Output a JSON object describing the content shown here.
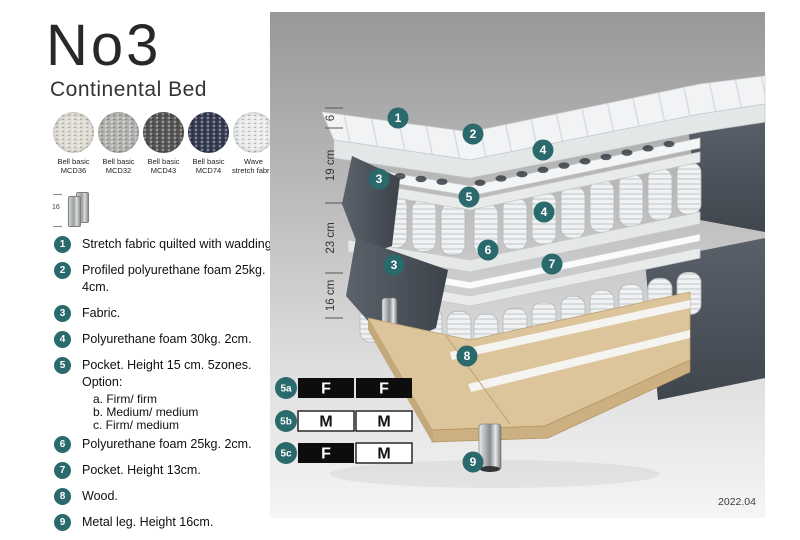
{
  "header": {
    "title": "No3",
    "subtitle": "Continental Bed"
  },
  "swatches": [
    {
      "line1": "Bell basic",
      "line2": "MCD36",
      "color": "#dfdcd4"
    },
    {
      "line1": "Bell basic",
      "line2": "MCD32",
      "color": "#b4b2af"
    },
    {
      "line1": "Bell basic",
      "line2": "MCD43",
      "color": "#545453"
    },
    {
      "line1": "Bell basic",
      "line2": "MCD74",
      "color": "#343a52"
    },
    {
      "line1": "Wave",
      "line2": "stretch fabric",
      "color": "#e9ebed"
    }
  ],
  "leg_thumbnail": {
    "height_label": "16"
  },
  "specs": [
    {
      "num": "1",
      "text": "Stretch fabric quilted with wadding."
    },
    {
      "num": "2",
      "text": "Profiled polyurethane foam 25kg. 4cm."
    },
    {
      "num": "3",
      "text": "Fabric."
    },
    {
      "num": "4",
      "text": "Polyurethane foam 30kg. 2cm."
    },
    {
      "num": "5",
      "text": "Pocket. Height 15 cm. 5zones. Option:",
      "options": [
        "a. Firm/ firm",
        "b. Medium/ medium",
        "c. Firm/ medium"
      ]
    },
    {
      "num": "6",
      "text": "Polyurethane foam 25kg. 2cm."
    },
    {
      "num": "7",
      "text": "Pocket. Height 13cm."
    },
    {
      "num": "8",
      "text": "Wood."
    },
    {
      "num": "9",
      "text": "Metal leg. Height 16cm."
    }
  ],
  "diagram": {
    "dimension_labels": [
      "6",
      "19 cm",
      "23 cm",
      "16 cm"
    ],
    "callouts": [
      {
        "num": "1"
      },
      {
        "num": "2"
      },
      {
        "num": "4"
      },
      {
        "num": "3"
      },
      {
        "num": "5"
      },
      {
        "num": "4"
      },
      {
        "num": "6"
      },
      {
        "num": "7"
      },
      {
        "num": "3"
      },
      {
        "num": "8"
      },
      {
        "num": "9"
      }
    ],
    "firmness_options": [
      {
        "label": "5a",
        "cells": [
          {
            "text": "F",
            "variant": "dark"
          },
          {
            "text": "F",
            "variant": "dark"
          }
        ]
      },
      {
        "label": "5b",
        "cells": [
          {
            "text": "M",
            "variant": "light"
          },
          {
            "text": "M",
            "variant": "light"
          }
        ]
      },
      {
        "label": "5c",
        "cells": [
          {
            "text": "F",
            "variant": "dark"
          },
          {
            "text": "M",
            "variant": "light"
          }
        ]
      }
    ],
    "version": "2022.04"
  },
  "colors": {
    "accent_teal": "#2b6a6c",
    "fabric_dark": "#4a5058",
    "wood": "#dcc49b",
    "panel_top": "#989898",
    "panel_bottom": "#f5f5f5"
  }
}
